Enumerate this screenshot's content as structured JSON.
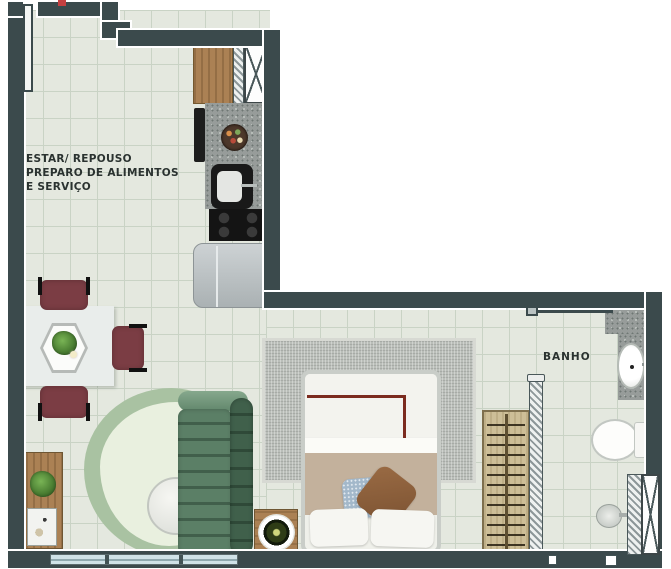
{
  "labels": {
    "living": {
      "line1": "ESTAR/ REPOUSO",
      "line2": "PREPARO DE ALIMENTOS",
      "line3": "E SERVIÇO"
    },
    "bathroom": "BANHO"
  },
  "furniture": {
    "living": [
      "entry-door",
      "dining-table",
      "dining-chairs",
      "hex-planter",
      "sideboard",
      "potted-plant",
      "organic-rug",
      "round-coffee-table",
      "channel-tufted-sofa",
      "side-table"
    ],
    "kitchen": [
      "upper-cabinet",
      "service-duct",
      "granite-countertop",
      "fruit-bowl",
      "sink",
      "cooktop",
      "refrigerator"
    ],
    "bedroom": [
      "double-bed",
      "decor-pillows",
      "area-rug",
      "nightstand-tray",
      "open-clothes-rack"
    ],
    "bathroom": [
      "sliding-door",
      "granite-vanity",
      "washbasin",
      "toilet",
      "shower-head",
      "shaft-duct"
    ]
  },
  "palette": {
    "wall": "#3b4a4c",
    "floor": "#e4e8df",
    "grid": "#c9d3c5",
    "window": "#cfe2e7",
    "wood": "#ab8154",
    "granite": "#979c9a",
    "fridge": "#c0c6c8",
    "chair": "#7b3d44",
    "table": "#e9edeb",
    "rug_living_outer": "#a9c2a2",
    "rug_living_inner": "#e9f0df",
    "rug_bedroom": "#babeb9",
    "sofa": "#56795f",
    "sofa_dark": "#3d5a47",
    "bed_frame": "#c9cdc8",
    "duvet": "#f3f3ee",
    "blanket": "#c3b19c",
    "pillow_blue": "#a3b8ca",
    "pillow_brown": "#8a5d3b",
    "accent_line": "#7b2b1f",
    "text": "#2a3230",
    "marker_red": "#c54040"
  }
}
